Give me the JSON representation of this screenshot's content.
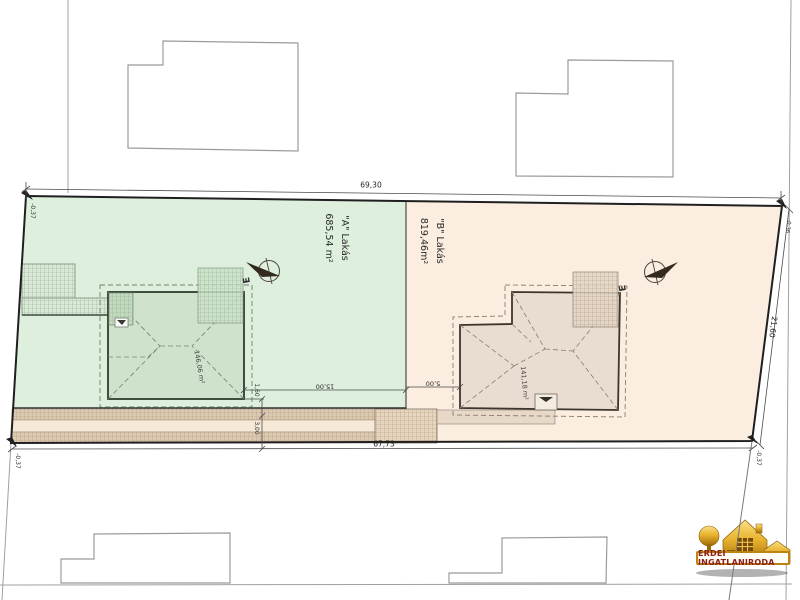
{
  "parcels": {
    "a": {
      "name": "\"A\" Lakás",
      "area": "685,54 m²",
      "building_area": "146,06 m²"
    },
    "b": {
      "name": "\"B\" Lakás",
      "area": "819,46m²",
      "building_area": "141,18 m²"
    }
  },
  "dimensions": {
    "street_front": "69,30",
    "rear": "67,73",
    "right_side": "21,60",
    "setback_a": "15,00",
    "setback_b": "5,00",
    "eave_offset": "1,60",
    "strip_width": "3,00",
    "offset_top_left": "-0,37",
    "offset_bottom_left": "-0,37",
    "offset_bottom_right": "-0,37",
    "offset_top_right": "-0,36"
  },
  "symbols": {
    "electric_a": "E",
    "electric_b": "E"
  },
  "logo": {
    "name": "ERDEI INGATLANIRODA"
  },
  "colors": {
    "parcel_a_fill": "#def0dd",
    "parcel_b_fill": "#fbeee0",
    "building_a_fill": "#cfe2cc",
    "building_b_fill": "#e9ddd1",
    "strip_fill": "#dcc9b2",
    "boundary": "#1f1f1f",
    "logo_gold": "#e8b22e",
    "logo_text": "#8b1d12"
  }
}
